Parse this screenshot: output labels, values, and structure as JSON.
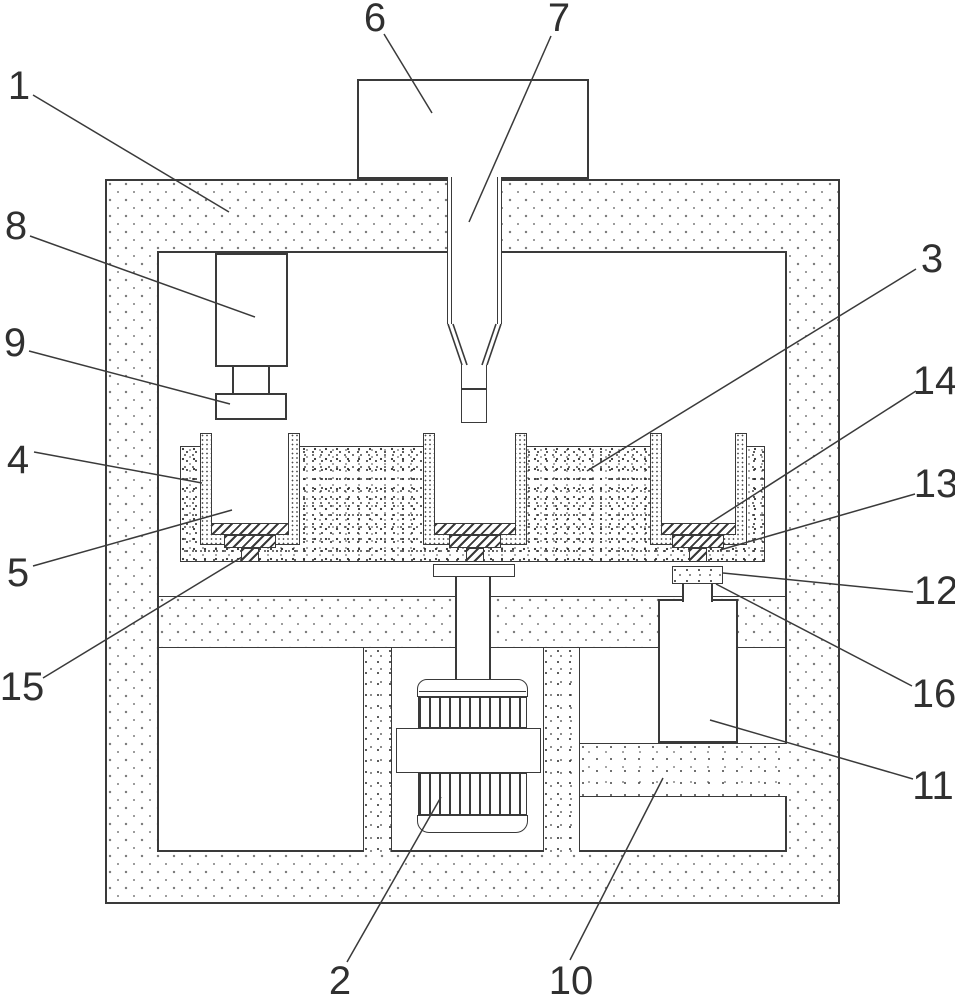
{
  "figure": {
    "type": "patent-line-drawing",
    "background": "#ffffff",
    "line_color": "#3a3a3a",
    "label_color": "#303030",
    "labels": [
      {
        "text": "1",
        "cx": 19,
        "cy": 86,
        "leader": [
          33,
          95,
          229,
          212
        ]
      },
      {
        "text": "8",
        "cx": 16,
        "cy": 226,
        "leader": [
          30,
          236,
          255,
          317
        ]
      },
      {
        "text": "9",
        "cx": 15,
        "cy": 343,
        "leader": [
          29,
          351,
          230,
          404
        ]
      },
      {
        "text": "4",
        "cx": 18,
        "cy": 460,
        "leader": [
          34,
          452,
          202,
          483
        ]
      },
      {
        "text": "5",
        "cx": 18,
        "cy": 573,
        "leader": [
          33,
          566,
          232,
          510
        ]
      },
      {
        "text": "15",
        "cx": 22,
        "cy": 687,
        "leader": [
          43,
          678,
          242,
          557
        ]
      },
      {
        "text": "6",
        "cx": 375,
        "cy": 18,
        "leader": [
          384,
          34,
          432,
          113
        ]
      },
      {
        "text": "7",
        "cx": 559,
        "cy": 18,
        "leader": [
          551,
          36,
          469,
          222
        ]
      },
      {
        "text": "3",
        "cx": 932,
        "cy": 259,
        "leader": [
          916,
          269,
          587,
          471
        ]
      },
      {
        "text": "14",
        "cx": 935,
        "cy": 381,
        "leader": [
          916,
          391,
          710,
          523
        ]
      },
      {
        "text": "13",
        "cx": 936,
        "cy": 484,
        "leader": [
          915,
          494,
          720,
          550
        ]
      },
      {
        "text": "12",
        "cx": 936,
        "cy": 591,
        "leader": [
          913,
          592,
          723,
          573
        ]
      },
      {
        "text": "16",
        "cx": 934,
        "cy": 694,
        "leader": [
          912,
          686,
          716,
          584
        ]
      },
      {
        "text": "11",
        "cx": 933,
        "cy": 786,
        "leader": [
          913,
          779,
          710,
          720
        ]
      },
      {
        "text": "2",
        "cx": 340,
        "cy": 981,
        "leader": [
          347,
          962,
          441,
          797
        ]
      },
      {
        "text": "10",
        "cx": 571,
        "cy": 981,
        "leader": [
          570,
          960,
          663,
          778
        ]
      }
    ]
  }
}
